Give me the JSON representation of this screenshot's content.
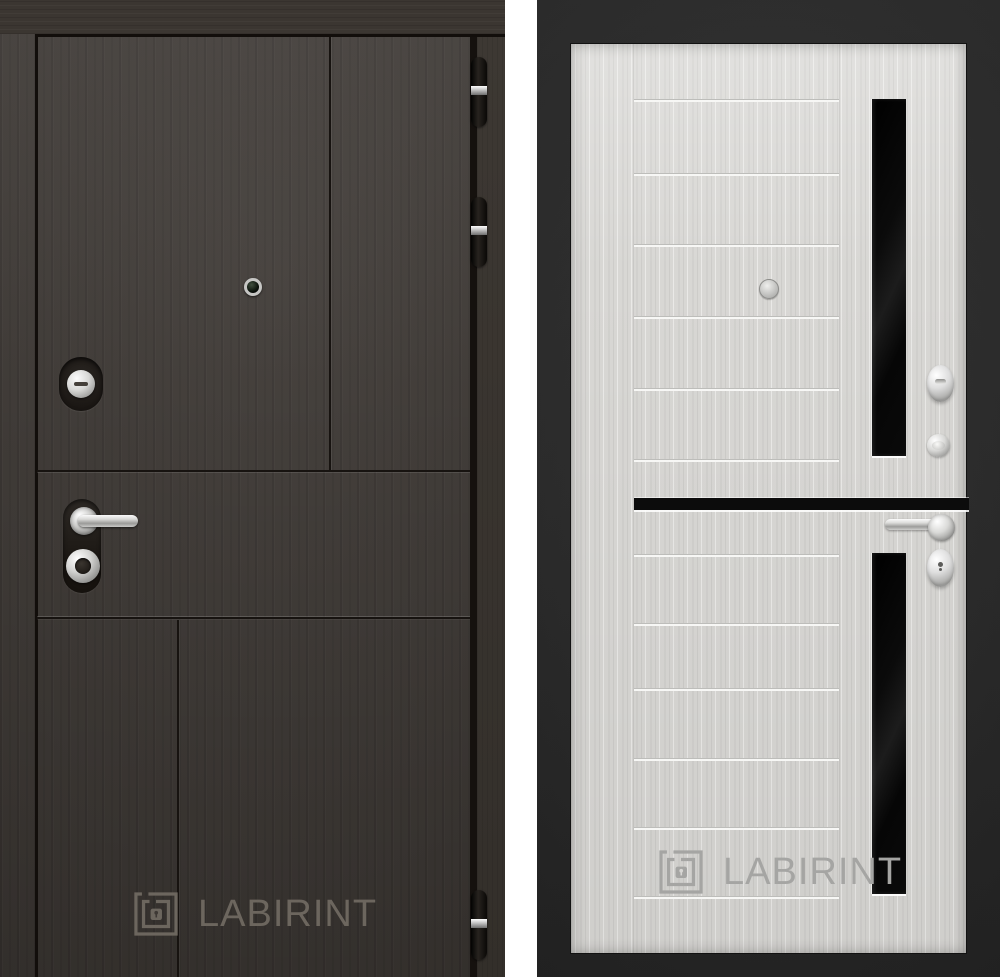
{
  "photo": {
    "background_color": "#ffffff",
    "subject": "steel entrance door, exterior and interior sides"
  },
  "left_door": {
    "side": "exterior",
    "finish_color": "#3e3935",
    "hardware_color": "#cccccc",
    "hinge_color": "#151210",
    "hinges_y": [
      57,
      197,
      890
    ],
    "watermark": {
      "text": "LABIRINT",
      "color": "#6c665e"
    }
  },
  "right_door": {
    "side": "interior",
    "leaf_color": "#d8d7d4",
    "frame_color": "#2a2a2a",
    "glass_color": "#0a0a0a",
    "leaf_top": 43,
    "groove_lines_y": [
      98,
      172,
      243,
      315,
      387,
      458,
      553,
      622,
      687,
      757,
      826,
      895
    ],
    "watermark": {
      "text": "LABIRINT",
      "color": "#a5a5a3"
    }
  }
}
